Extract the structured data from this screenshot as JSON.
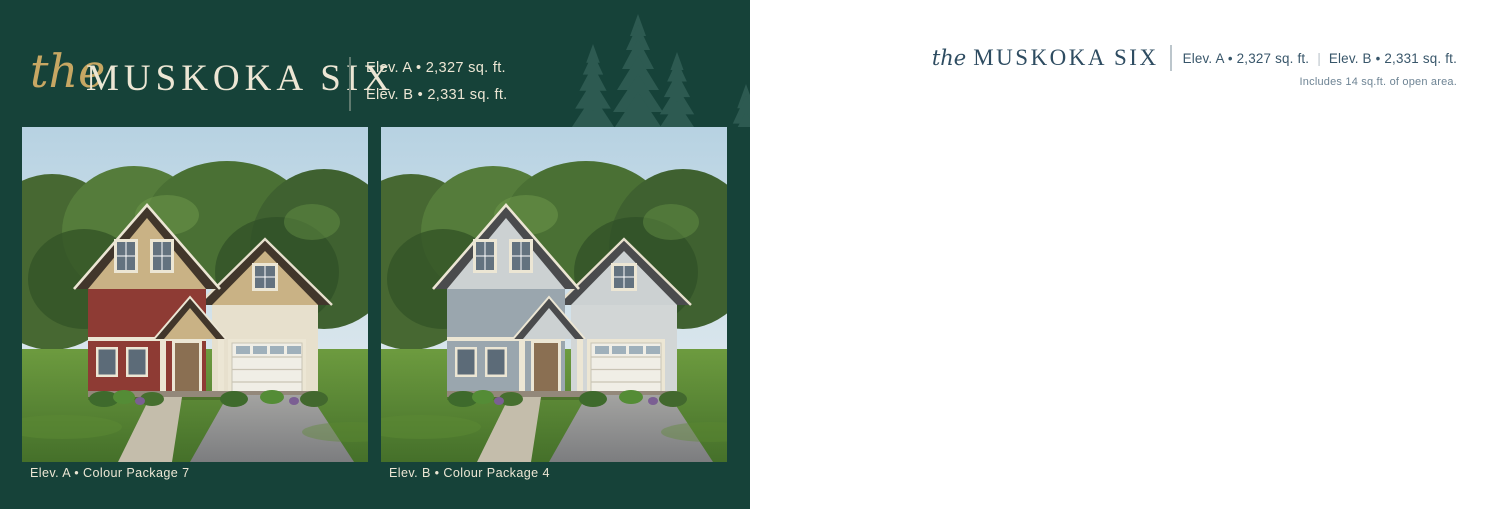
{
  "colors": {
    "panel_green": "#164239",
    "tree_green": "#2d5a51",
    "gold": "#c7a763",
    "cream": "#ece6d4",
    "slate": "#2e4c61",
    "slate_light": "#6e8494",
    "level_teal": "#4b8595",
    "plan_line": "#1d1d1d",
    "disclaimer_gray": "#a3a3a3",
    "divider_green": "#5f7a6f",
    "divider_gray": "#bcc6cc",
    "elev_a_siding": "#8e3b34",
    "elev_a_gable": "#c9b285",
    "elev_a_roof": "#41362b",
    "elev_a_accent": "#e7e0cd",
    "elev_b_siding": "#9aa6ae",
    "elev_b_gable": "#ccd1d2",
    "elev_b_roof": "#4a4b4d",
    "elev_b_accent": "#d2d6d6"
  },
  "left_panel": {
    "script_word": "the",
    "title": "MUSKOKA SIX",
    "elev_a_sqft": "Elev. A • 2,327 sq. ft.",
    "elev_b_sqft": "Elev. B • 2,331 sq. ft.",
    "caption_a": "Elev. A  •  Colour Package 7",
    "caption_b": "Elev. B  •  Colour Package 4"
  },
  "right_panel": {
    "script_word": "the",
    "title": "MUSKOKA SIX",
    "elev_a_sqft": "Elev. A • 2,327 sq. ft.",
    "elev_b_sqft": "Elev. B • 2,331 sq. ft.",
    "open_area_note": "Includes 14 sq.ft. of open area.",
    "page_number": "24",
    "disclaimer": "Illustrations are artist's concept. All dimensions are approximate. Specifications, terms and conditions are subject to change without notice. Floor plans and room dimensions apply to elevation A of this model type and may vary according to elevation. Plan may be built with mirror image. Location of furnace, hot water tank, support posts and beams are determined by the HVAC designer or architect and may result in drywall boxes on walls and ceilings that are not shown. The size and location of the utility area are approximate. The number of steps at front and rear may vary depending on grading. E. & O.E. • 8806-0006"
  },
  "main_level": {
    "title": "MAIN LEVEL",
    "elev_a": "ELEV. A",
    "elev_b": "ELEV. B",
    "deck_note": "OPT. DECK",
    "dinette": "DINETTE",
    "dinette_dims": "11'-0\" x 10'-2\"",
    "kitchen": "KITCHEN",
    "kitchen_dims": "11'-0\" x 9'-8\"",
    "great_room": "GREAT ROOM",
    "great_room_dims": "14'-10\" x 16'-0\"",
    "dining_room": "DINING ROOM",
    "dining_room_dims": "14'-10\" x 9'-11\"",
    "half_wall": "OPT. HALF WALL",
    "opt_fireplace": "OPT. FIREPLACE",
    "mudroom": "MUDROOM",
    "step_dn": "STEP DN",
    "bench": "BENCH",
    "garage": "GARAGE",
    "garage_dims": "10'-2\" x 20'-0\"",
    "garage_note": "OPT. DOOR AT ELEV. B",
    "foyer": "FOYER",
    "covered_porch": "COVERED PORCH",
    "foyer_b": "FOYER",
    "covered_porch_b": "COVERED PORCH"
  },
  "upper_level": {
    "title": "UPPER LEVEL",
    "elev_ab": "ELEV. A & B",
    "ensuite": "ENSUITE",
    "master": "MASTER BEDROOM",
    "master_dims": "14'-6\" x 12'-8\"",
    "laundry": "LAUNDRY",
    "opt_tub": "OPTIONAL LAUNDRY TUB",
    "bedroom2": "BEDROOM 2",
    "bedroom2_dims": "9'-10\" x 11'-8\"",
    "main_bath": "MAIN BATH",
    "tub_note": "TUB/SHOWER",
    "bedroom3": "BEDROOM 3",
    "bedroom3_dims": "10'-0\" x 11'-0\"",
    "bedroom4": "BEDROOM 4",
    "bedroom4_dims": "9'-8\" x 11'-0\"",
    "open_above": "OPEN TO ABOVE",
    "vaulted": "VAULTED CEILING"
  },
  "lower_level": {
    "title": "LOWER LEVEL",
    "elev_a": "ELEV. A",
    "elev_b": "ELEV. B",
    "unfinished": "UNFINISHED BASEMENT",
    "unexcavated": "UNEXCAVATED",
    "unexcavated2": "UNEXCAVATED",
    "deck_above": "DECK ABOVE",
    "furnace": "FURNACE",
    "low_headroom": "LOW HEADROOM",
    "bath_note": "OPT. 3-PC BATH"
  }
}
